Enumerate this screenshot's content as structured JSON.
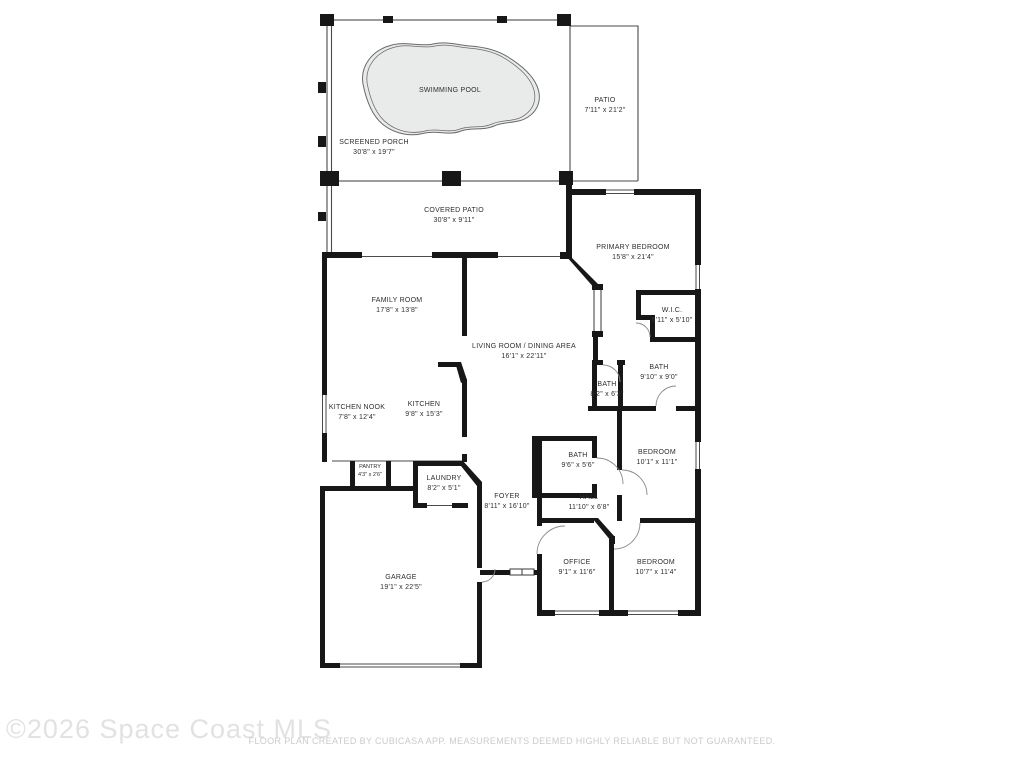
{
  "title": "Residential floor plan",
  "rooms": [
    {
      "id": "swimming-pool",
      "name": "SWIMMING POOL",
      "dims": ""
    },
    {
      "id": "screened-porch",
      "name": "SCREENED PORCH",
      "dims": "30'8\" x 19'7\""
    },
    {
      "id": "patio",
      "name": "PATIO",
      "dims": "7'11\" x 21'2\""
    },
    {
      "id": "covered-patio",
      "name": "COVERED PATIO",
      "dims": "30'8\" x 9'11\""
    },
    {
      "id": "primary-bedroom",
      "name": "PRIMARY BEDROOM",
      "dims": "15'8\" x 21'4\""
    },
    {
      "id": "family-room",
      "name": "FAMILY ROOM",
      "dims": "17'8\" x 13'8\""
    },
    {
      "id": "living-dining",
      "name": "LIVING ROOM / DINING AREA",
      "dims": "16'1\" x 22'11\""
    },
    {
      "id": "wic",
      "name": "W.I.C.",
      "dims": "6'11\" x 5'10\""
    },
    {
      "id": "bath-primary",
      "name": "BATH",
      "dims": "9'10\" x 9'0\""
    },
    {
      "id": "bath-guest",
      "name": "BATH",
      "dims": "8'2\" x 6'3\""
    },
    {
      "id": "kitchen-nook",
      "name": "KITCHEN NOOK",
      "dims": "7'8\" x 12'4\""
    },
    {
      "id": "kitchen",
      "name": "KITCHEN",
      "dims": "9'8\" x 15'3\""
    },
    {
      "id": "pantry",
      "name": "PANTRY",
      "dims": "4'3\" x 2'6\""
    },
    {
      "id": "laundry",
      "name": "LAUNDRY",
      "dims": "8'2\" x 5'1\""
    },
    {
      "id": "foyer",
      "name": "FOYER",
      "dims": "8'11\" x 16'10\""
    },
    {
      "id": "bath-hall",
      "name": "BATH",
      "dims": "9'6\" x 5'6\""
    },
    {
      "id": "hall",
      "name": "HALL",
      "dims": "11'10\" x 6'8\""
    },
    {
      "id": "bedroom-1",
      "name": "BEDROOM",
      "dims": "10'1\" x 11'1\""
    },
    {
      "id": "office",
      "name": "OFFICE",
      "dims": "9'1\" x 11'6\""
    },
    {
      "id": "bedroom-2",
      "name": "BEDROOM",
      "dims": "10'7\" x 11'4\""
    },
    {
      "id": "garage",
      "name": "GARAGE",
      "dims": "19'1\" x 22'5\""
    }
  ],
  "footer": {
    "watermark": "©2026 Space Coast MLS",
    "disclaimer": "FLOOR PLAN CREATED BY CUBICASA APP. MEASUREMENTS DEEMED HIGHLY RELIABLE BUT NOT GUARANTEED."
  },
  "colors": {
    "wall": "#171717",
    "pool": "#e9eaea",
    "label": "#2e2e2e",
    "watermark": "#e2e2e2",
    "disclaimer": "#cbcbcb"
  }
}
